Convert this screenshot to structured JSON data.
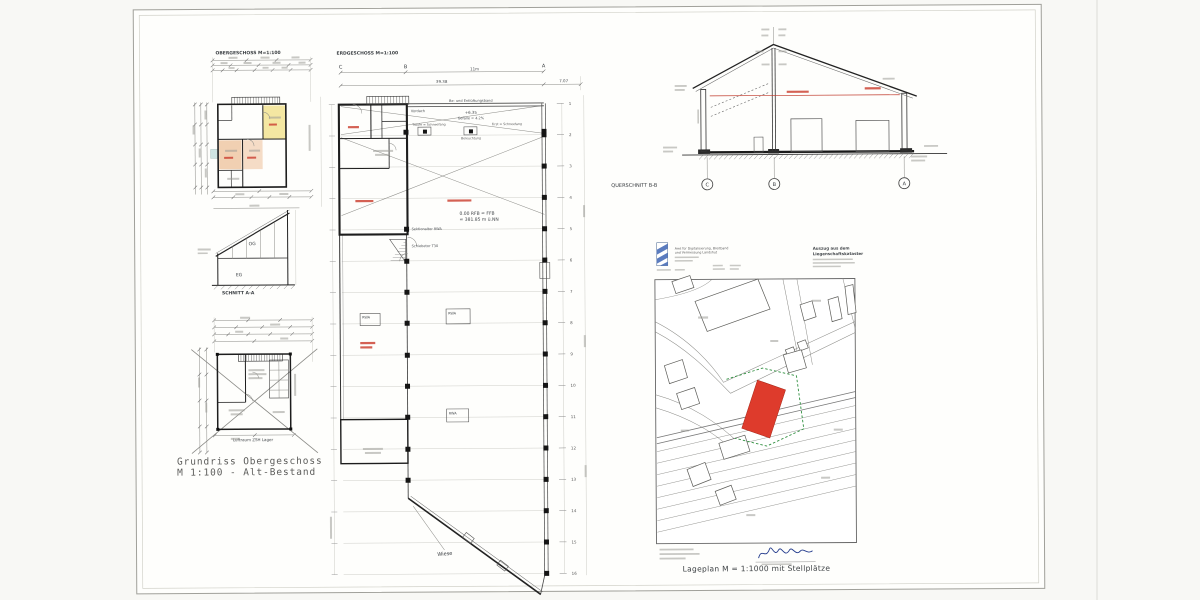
{
  "og_plan": {
    "title": "OBERGESCHOSS M=1:100"
  },
  "schnitt_aa": {
    "caption": "SCHNITT A-A",
    "og": "OG",
    "eg": "EG"
  },
  "alt_plan": {
    "caption1": "Grundriss Obergeschoss",
    "caption2": "M 1:100 - Alt-Bestand",
    "luftraum": "Luftraum ZSH Lager"
  },
  "eg_plan": {
    "title": "ERDGESCHOSS M=1:100",
    "grid_letters": [
      "C",
      "B",
      "A"
    ],
    "row_numbers": [
      "1",
      "2",
      "3",
      "4",
      "5",
      "6",
      "7",
      "8",
      "9",
      "10",
      "11",
      "12",
      "13",
      "14",
      "15",
      "16"
    ],
    "dim_total": "39.38",
    "dim_bay": "11m",
    "dim_right": "7.07",
    "vent_band": "Be- und Entlüftungsband",
    "vordach": "Vordach",
    "ridge": "+6.35",
    "slope": "Gefälle = 4.2%",
    "traufe_left": "Traufe = Schneefang",
    "traufe_right": "First = Schneefang",
    "beleuchtung": "Beleuchtung",
    "level1": "0.00 RFB = FFB",
    "level2": "= 381.85 m ü.NN",
    "sektionaltor": "Sektionaltor RWA",
    "schiebetor": "Schiebetor T30",
    "rwa": "RWA",
    "wiese": "Wiese"
  },
  "querschnitt": {
    "caption": "QUERSCHNITT B-B",
    "grid_letters": [
      "C",
      "B",
      "A"
    ]
  },
  "lageplan": {
    "office1": "Amt für Digitalisierung, Breitband",
    "office2": "und Vermessung Landshut",
    "extract1": "Auszug aus dem",
    "extract2": "Liegenschaftskataster",
    "caption": "Lageplan M = 1:1000  mit Stellplätze"
  },
  "colors": {
    "room_yellow": "#f4e7a2",
    "room_orange": "#f1d0b2",
    "room_orange2": "#f5dcc6",
    "room_cyan": "#cfe4e2",
    "parcel_red": "#de3b2c",
    "green_dash": "#2f8f3f",
    "cad_red": "#c23b2e"
  }
}
